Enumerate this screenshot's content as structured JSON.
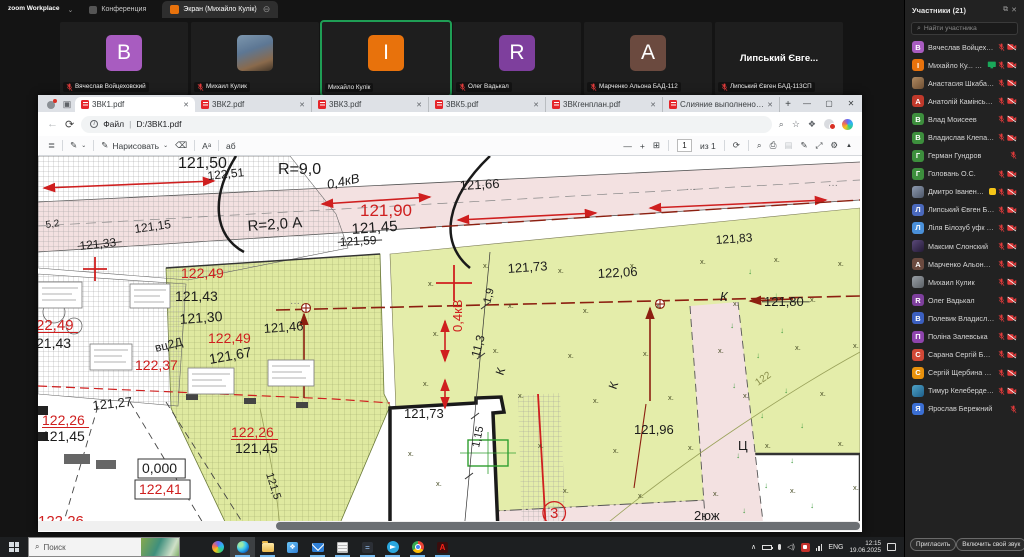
{
  "zoom": {
    "app_title": "zoom Workplace",
    "tabs": {
      "meeting": "Конференция",
      "screen": "Экран (Михайло Кулік)"
    },
    "video_tiles": [
      {
        "kind": "initial",
        "letter": "B",
        "color": "#a85cc0",
        "name": "Вячеслав Войцеховский",
        "muted": true,
        "active": false
      },
      {
        "kind": "photo",
        "letter": "",
        "color": "",
        "name": "Михаил Кулик",
        "muted": true,
        "active": false
      },
      {
        "kind": "initial",
        "letter": "I",
        "color": "#e8720c",
        "name": "Михайло Кулік",
        "muted": false,
        "active": true
      },
      {
        "kind": "initial",
        "letter": "R",
        "color": "#7e3f9d",
        "name": "Олег Вадькал",
        "muted": true,
        "active": false
      },
      {
        "kind": "initial",
        "letter": "A",
        "color": "#6b4a3f",
        "name": "Марченко Альона БАД-112",
        "muted": true,
        "active": false
      },
      {
        "kind": "name",
        "display": "Липський Євге...",
        "name": "Липський Євген БАД-113СП",
        "muted": true,
        "active": false
      }
    ],
    "participants_panel": {
      "header": "Участники (21)",
      "search_placeholder": "Найти участника",
      "invite_button": "Пригласить",
      "unmute_button": "Включить свой звук",
      "participants": [
        {
          "name": "Вячеслав Войцеховський (Я)",
          "initial": "В",
          "color": "#a85cc0",
          "photo": "",
          "icons": [
            "mic",
            "cam"
          ],
          "extra": ""
        },
        {
          "name": "Михайло Ку... (Организатор)",
          "initial": "І",
          "color": "#e8720c",
          "photo": "",
          "icons": [
            "mic",
            "cam"
          ],
          "extra": "share"
        },
        {
          "name": "Анастасия Шкабарня БАД-114",
          "initial": "",
          "color": "",
          "photo": "photo-a",
          "icons": [
            "mic",
            "cam"
          ],
          "extra": ""
        },
        {
          "name": "Анатолій Камінський БАД-113",
          "initial": "А",
          "color": "#c0392b",
          "photo": "",
          "icons": [
            "mic",
            "cam"
          ],
          "extra": ""
        },
        {
          "name": "Влад Моисеев",
          "initial": "В",
          "color": "#3d8f3d",
          "photo": "",
          "icons": [
            "mic",
            "cam"
          ],
          "extra": ""
        },
        {
          "name": "Владислав Клепачко",
          "initial": "В",
          "color": "#3d8f3d",
          "photo": "",
          "icons": [
            "mic",
            "cam"
          ],
          "extra": ""
        },
        {
          "name": "Герман Гундров",
          "initial": "Г",
          "color": "#3d8f3d",
          "photo": "",
          "icons": [
            "mic"
          ],
          "extra": ""
        },
        {
          "name": "Головань О.С.",
          "initial": "Г",
          "color": "#3d8f3d",
          "photo": "",
          "icons": [
            "mic",
            "cam"
          ],
          "extra": ""
        },
        {
          "name": "Дмитро Іваненко (эксперт ...",
          "initial": "",
          "color": "",
          "photo": "photo-b",
          "icons": [
            "mic",
            "cam"
          ],
          "extra": "thumb"
        },
        {
          "name": "Липський Євген БАД-113СП",
          "initial": "Л",
          "color": "#4a69bd",
          "photo": "",
          "icons": [
            "mic",
            "cam"
          ],
          "extra": ""
        },
        {
          "name": "Ліля Білозуб уфк 112з_2",
          "initial": "Л",
          "color": "#4a90d9",
          "photo": "",
          "icons": [
            "mic",
            "cam"
          ],
          "extra": ""
        },
        {
          "name": "Максим Слонский",
          "initial": "",
          "color": "",
          "photo": "photo-c",
          "icons": [
            "mic",
            "cam"
          ],
          "extra": ""
        },
        {
          "name": "Марченко Альона БАД-112",
          "initial": "А",
          "color": "#6b4a3f",
          "photo": "",
          "icons": [
            "mic",
            "cam"
          ],
          "extra": ""
        },
        {
          "name": "Михаил Кулик",
          "initial": "",
          "color": "",
          "photo": "photo-d",
          "icons": [
            "mic",
            "cam"
          ],
          "extra": ""
        },
        {
          "name": "Олег Вадькал",
          "initial": "R",
          "color": "#7e3f9d",
          "photo": "",
          "icons": [
            "mic",
            "cam"
          ],
          "extra": ""
        },
        {
          "name": "Полевик Владислав",
          "initial": "В",
          "color": "#3b5fc0",
          "photo": "",
          "icons": [
            "mic",
            "cam"
          ],
          "extra": ""
        },
        {
          "name": "Поліна Залевська",
          "initial": "П",
          "color": "#8e44ad",
          "photo": "",
          "icons": [
            "mic",
            "cam"
          ],
          "extra": ""
        },
        {
          "name": "Сарана Сергій БАД-114",
          "initial": "С",
          "color": "#d14836",
          "photo": "",
          "icons": [
            "mic",
            "cam"
          ],
          "extra": ""
        },
        {
          "name": "Сергій Щербина БАД 122",
          "initial": "С",
          "color": "#e8910c",
          "photo": "",
          "icons": [
            "mic",
            "cam"
          ],
          "extra": ""
        },
        {
          "name": "Тимур Келеберденко БАД 113",
          "initial": "",
          "color": "",
          "photo": "photo-e",
          "icons": [
            "mic",
            "cam"
          ],
          "extra": ""
        },
        {
          "name": "Ярослав Бережний",
          "initial": "Я",
          "color": "#3b6fd4",
          "photo": "",
          "icons": [
            "mic"
          ],
          "extra": ""
        }
      ]
    }
  },
  "browser": {
    "tabs": [
      {
        "title": "3ВК1.pdf",
        "active": true
      },
      {
        "title": "3ВК2.pdf",
        "active": false
      },
      {
        "title": "3ВК3.pdf",
        "active": false
      },
      {
        "title": "3ВК5.pdf",
        "active": false
      },
      {
        "title": "3ВКгенплан.pdf",
        "active": false
      },
      {
        "title": "Слияние выполнено_202...",
        "active": false
      }
    ],
    "address": {
      "scheme_label": "Файл",
      "url": "D:/3ВК1.pdf"
    },
    "pdf_toolbar": {
      "draw_label": "Нарисовать",
      "page_current": "1",
      "page_total": "из 1"
    }
  },
  "drawing": {
    "colors": {
      "lime": "#e4edaa",
      "plot_lime": "#dfe9a0",
      "pink": "#f3e1e1",
      "red": "#cf1f1f",
      "maroon": "#8c1f10"
    },
    "labels": [
      {
        "t": "121,50",
        "x": 140,
        "y": 12,
        "s": 16
      },
      {
        "t": "122,51",
        "x": 170,
        "y": 24,
        "s": 12,
        "r": -6
      },
      {
        "t": "R=9,0",
        "x": 240,
        "y": 18,
        "s": 16
      },
      {
        "t": "0,4кВ",
        "x": 290,
        "y": 33,
        "s": 13,
        "r": -12,
        "i": 1
      },
      {
        "t": "121,66",
        "x": 422,
        "y": 34,
        "s": 13,
        "r": -3
      },
      {
        "t": "121,90",
        "x": 322,
        "y": 60,
        "s": 17,
        "c": "red"
      },
      {
        "t": "R=2,0 А",
        "x": 210,
        "y": 75,
        "s": 15,
        "r": -4
      },
      {
        "t": "121,45",
        "x": 314,
        "y": 78,
        "s": 15,
        "r": -4
      },
      {
        "t": "121,59",
        "x": 302,
        "y": 90,
        "s": 12,
        "r": -3,
        "k": 1
      },
      {
        "t": "121,83",
        "x": 678,
        "y": 88,
        "s": 12,
        "r": -4
      },
      {
        "t": "5,2",
        "x": 8,
        "y": 72,
        "s": 10,
        "r": -8
      },
      {
        "t": "121,15",
        "x": 97,
        "y": 77,
        "s": 12,
        "r": -8
      },
      {
        "t": "121,33",
        "x": 42,
        "y": 94,
        "s": 12,
        "r": -6,
        "k": 1
      },
      {
        "t": "122,49",
        "x": 143,
        "y": 122,
        "s": 14,
        "c": "red"
      },
      {
        "t": "22,49",
        "x": -2,
        "y": 174,
        "s": 15,
        "c": "red",
        "u": 1
      },
      {
        "t": "21,43",
        "x": -2,
        "y": 192,
        "s": 14
      },
      {
        "t": "121,43",
        "x": 137,
        "y": 145,
        "s": 14
      },
      {
        "t": "121,30",
        "x": 142,
        "y": 168,
        "s": 14,
        "r": -4
      },
      {
        "t": "121,46",
        "x": 226,
        "y": 177,
        "s": 13,
        "r": -4
      },
      {
        "t": "122,49",
        "x": 170,
        "y": 187,
        "s": 14,
        "c": "red"
      },
      {
        "t": "вц2Д",
        "x": 118,
        "y": 196,
        "s": 12,
        "r": -14
      },
      {
        "t": "121,67",
        "x": 172,
        "y": 208,
        "s": 14,
        "r": -10
      },
      {
        "t": "122,37",
        "x": 97,
        "y": 214,
        "s": 14,
        "c": "red"
      },
      {
        "t": "121,27",
        "x": 55,
        "y": 254,
        "s": 13,
        "r": -6
      },
      {
        "t": "122,26",
        "x": 4,
        "y": 269,
        "s": 14,
        "c": "red",
        "u": 1
      },
      {
        "t": "121,45",
        "x": 4,
        "y": 285,
        "s": 14
      },
      {
        "t": "0,000",
        "x": 104,
        "y": 317,
        "s": 14,
        "b": 1
      },
      {
        "t": "122,41",
        "x": 101,
        "y": 338,
        "s": 14,
        "c": "red",
        "b": 1
      },
      {
        "t": "122,26",
        "x": 193,
        "y": 281,
        "s": 14,
        "c": "red",
        "u": 1
      },
      {
        "t": "121,45",
        "x": 197,
        "y": 297,
        "s": 14
      },
      {
        "t": "121,5",
        "x": 228,
        "y": 318,
        "s": 11,
        "r": 72
      },
      {
        "t": "122,26",
        "x": 0,
        "y": 370,
        "s": 15,
        "c": "red"
      },
      {
        "t": "121,73",
        "x": 470,
        "y": 117,
        "s": 13,
        "r": -4
      },
      {
        "t": "122,06",
        "x": 560,
        "y": 122,
        "s": 13,
        "r": -3
      },
      {
        "t": "121,80",
        "x": 726,
        "y": 150,
        "s": 13,
        "k": 1
      },
      {
        "t": "К",
        "x": 682,
        "y": 145,
        "s": 13,
        "i": 1
      },
      {
        "t": "0,4кВ",
        "x": 424,
        "y": 176,
        "s": 13,
        "c": "red",
        "r": -90
      },
      {
        "t": "1,9",
        "x": 452,
        "y": 148,
        "s": 11,
        "r": -75
      },
      {
        "t": "11,3",
        "x": 441,
        "y": 202,
        "s": 12,
        "r": -75
      },
      {
        "t": "К",
        "x": 465,
        "y": 220,
        "s": 12,
        "r": -70
      },
      {
        "t": "К",
        "x": 578,
        "y": 234,
        "s": 12,
        "r": -70
      },
      {
        "t": "121,73",
        "x": 366,
        "y": 262,
        "s": 13
      },
      {
        "t": "1,15",
        "x": 441,
        "y": 292,
        "s": 11,
        "r": -78
      },
      {
        "t": "121,96",
        "x": 596,
        "y": 278,
        "s": 13
      },
      {
        "t": "Ц",
        "x": 700,
        "y": 294,
        "s": 13
      },
      {
        "t": "3",
        "x": 512,
        "y": 362,
        "s": 15,
        "c": "red",
        "o": 1
      },
      {
        "t": "2юж",
        "x": 656,
        "y": 364,
        "s": 13
      },
      {
        "t": "122",
        "x": 720,
        "y": 230,
        "s": 10,
        "r": -35,
        "c": "#8a8f4a"
      }
    ]
  },
  "taskbar": {
    "search_placeholder": "Поиск",
    "apps": [
      {
        "name": "task-view",
        "active": false,
        "running": false
      },
      {
        "name": "copilot",
        "active": false,
        "running": false
      },
      {
        "name": "edge",
        "active": true,
        "running": true
      },
      {
        "name": "file-explorer",
        "active": false,
        "running": true
      },
      {
        "name": "photos",
        "active": false,
        "running": false
      },
      {
        "name": "mail",
        "active": false,
        "running": true
      },
      {
        "name": "onenote",
        "active": false,
        "running": true
      },
      {
        "name": "calculator",
        "active": false,
        "running": true
      },
      {
        "name": "telegram",
        "active": false,
        "running": true
      },
      {
        "name": "chrome",
        "active": false,
        "running": true
      },
      {
        "name": "acrobat",
        "active": false,
        "running": true
      }
    ],
    "tray": {
      "lang": "ENG",
      "time": "12:15",
      "date": "19.06.2025"
    }
  }
}
